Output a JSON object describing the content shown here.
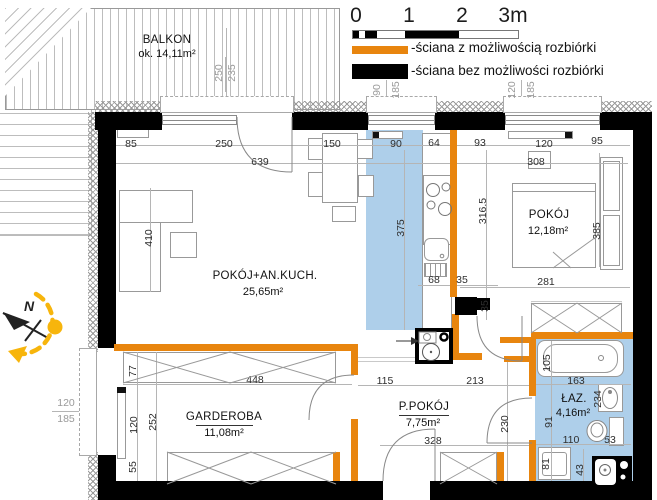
{
  "legend": {
    "scale": {
      "ticks": [
        "0",
        "1",
        "2",
        "3m"
      ]
    },
    "items": [
      {
        "label": "-ściana z możliwością rozbiórki"
      },
      {
        "label": "-ściana bez możliwości rozbiórki"
      }
    ]
  },
  "compass": {
    "north_label": "N"
  },
  "rooms": {
    "balkon": {
      "name": "BALKON",
      "area": "ok. 14,11m²"
    },
    "living": {
      "name": "POKÓJ+AN.KUCH.",
      "area": "25,65m²"
    },
    "pokoj": {
      "name": "POKÓJ",
      "area": "12,18m²"
    },
    "garderoba": {
      "name": "GARDEROBA",
      "area": "11,08m²"
    },
    "ppokoj": {
      "name": "P.POKÓJ",
      "area": "7,75m²"
    },
    "laz": {
      "name": "ŁAZ.",
      "area": "4,16m²"
    }
  },
  "dimensions": [
    {
      "t": "85",
      "x": 131,
      "y": 144
    },
    {
      "t": "250",
      "x": 224,
      "y": 144
    },
    {
      "t": "150",
      "x": 332,
      "y": 144
    },
    {
      "t": "90",
      "x": 396,
      "y": 144
    },
    {
      "t": "64",
      "x": 434,
      "y": 143
    },
    {
      "t": "93",
      "x": 480,
      "y": 143
    },
    {
      "t": "120",
      "x": 544,
      "y": 144
    },
    {
      "t": "95",
      "x": 597,
      "y": 141
    },
    {
      "t": "639",
      "x": 260,
      "y": 162
    },
    {
      "t": "308",
      "x": 536,
      "y": 162
    },
    {
      "t": "410",
      "x": 149,
      "y": 238,
      "rot": true
    },
    {
      "t": "375",
      "x": 401,
      "y": 228,
      "rot": true
    },
    {
      "t": "316.5",
      "x": 483,
      "y": 211,
      "rot": true
    },
    {
      "t": "385",
      "x": 597,
      "y": 231,
      "rot": true
    },
    {
      "t": "281",
      "x": 546,
      "y": 282
    },
    {
      "t": "68",
      "x": 434,
      "y": 280
    },
    {
      "t": "35",
      "x": 462,
      "y": 280
    },
    {
      "t": "35",
      "x": 485,
      "y": 306,
      "rot": true
    },
    {
      "t": "115",
      "x": 385,
      "y": 381
    },
    {
      "t": "213",
      "x": 475,
      "y": 381
    },
    {
      "t": "328",
      "x": 433,
      "y": 441
    },
    {
      "t": "230",
      "x": 505,
      "y": 424,
      "rot": true
    },
    {
      "t": "77",
      "x": 133,
      "y": 371,
      "rot": true
    },
    {
      "t": "448",
      "x": 255,
      "y": 380
    },
    {
      "t": "252",
      "x": 153,
      "y": 422,
      "rot": true
    },
    {
      "t": "120",
      "x": 134,
      "y": 425,
      "rot": true
    },
    {
      "t": "55",
      "x": 133,
      "y": 467,
      "rot": true
    },
    {
      "t": "105",
      "x": 547,
      "y": 363,
      "rot": true
    },
    {
      "t": "163",
      "x": 576,
      "y": 381
    },
    {
      "t": "234",
      "x": 598,
      "y": 399,
      "rot": true
    },
    {
      "t": "91",
      "x": 549,
      "y": 422,
      "rot": true
    },
    {
      "t": "110",
      "x": 571,
      "y": 440
    },
    {
      "t": "53",
      "x": 610,
      "y": 440
    },
    {
      "t": "81",
      "x": 546,
      "y": 464,
      "rot": true
    },
    {
      "t": "43",
      "x": 580,
      "y": 470,
      "rot": true
    }
  ],
  "window_specs": [
    {
      "t": "250",
      "x": 219,
      "y": 73,
      "rot": true
    },
    {
      "t": "235",
      "x": 232,
      "y": 73,
      "rot": true
    },
    {
      "t": "90",
      "x": 377,
      "y": 90,
      "rot": true
    },
    {
      "t": "185",
      "x": 396,
      "y": 90,
      "rot": true
    },
    {
      "t": "120",
      "x": 512,
      "y": 90,
      "rot": true
    },
    {
      "t": "185",
      "x": 531,
      "y": 90,
      "rot": true
    },
    {
      "t": "120",
      "x": 66,
      "y": 403
    },
    {
      "t": "185",
      "x": 66,
      "y": 419
    }
  ],
  "colors": {
    "demolition_wall": "#E8850E",
    "solid_wall": "#000000",
    "highlight_zone": "#AECFEA",
    "compass_arc": "#F7B50C"
  }
}
